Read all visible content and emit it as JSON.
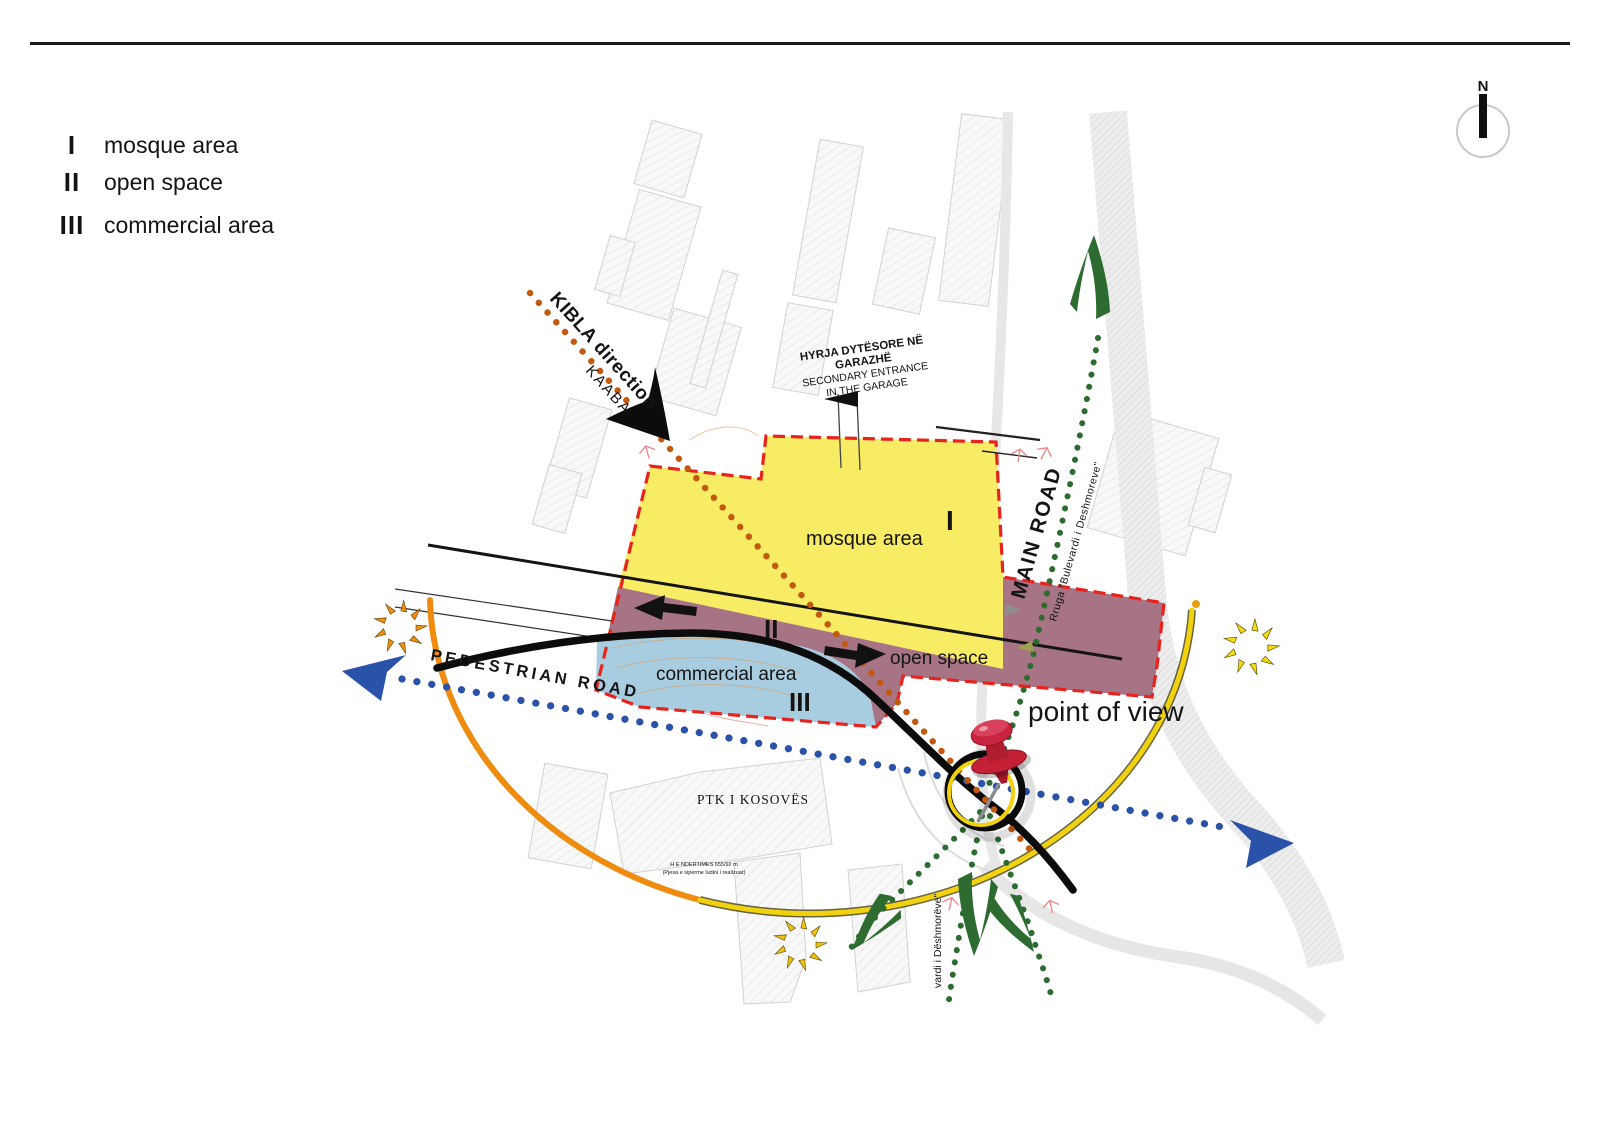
{
  "legend": {
    "items": [
      {
        "numeral": "I",
        "label": "mosque area"
      },
      {
        "numeral": "II",
        "label": "open space"
      },
      {
        "numeral": "III",
        "label": "commercial area"
      }
    ]
  },
  "compass": {
    "label": "N"
  },
  "map": {
    "zone_labels": {
      "mosque": "mosque area",
      "mosque_num": "I",
      "open": "open space",
      "open_num": "II",
      "commercial": "commercial area",
      "commercial_num": "III"
    },
    "kibla": {
      "title": "KIBLA direction",
      "subtitle": "KAABA"
    },
    "garage": {
      "line1": "HYRJA DYTËSORE NË",
      "line2": "GARAZHË",
      "line3": "SECONDARY ENTRANCE",
      "line4": "IN THE GARAGE"
    },
    "roads": {
      "main": "MAIN ROAD",
      "main_sub": "Rruga \"Bulevardi i Deshmoreve\"",
      "pedestrian": "PEDESTRIAN ROAD",
      "boulevard_note": "vardi i Dëshmorëve\""
    },
    "point_of_view": "point of view",
    "ptk": {
      "name": "PTK I KOSOVËS",
      "note1": "H E NDERTIMES 655/92 m",
      "note2": "(Pjesa e siperme ludini i realizuar)"
    }
  },
  "colors": {
    "zone_mosque": "#f7ec63",
    "zone_open_space": "#a67484",
    "zone_commercial": "#a9cde0",
    "red_dash": "#e8231d",
    "pedestrian_blue": "#2a52a8",
    "traffic_green": "#2e6b30",
    "kibla_orange": "#c2590e",
    "arc_orange": "#ef8c10",
    "arc_yellow": "#f0d30e",
    "sun_orange": "#ef8d15",
    "sun_yellow": "#f0de12",
    "sun_gold": "#eec40e",
    "pin_red": "#c42136"
  }
}
